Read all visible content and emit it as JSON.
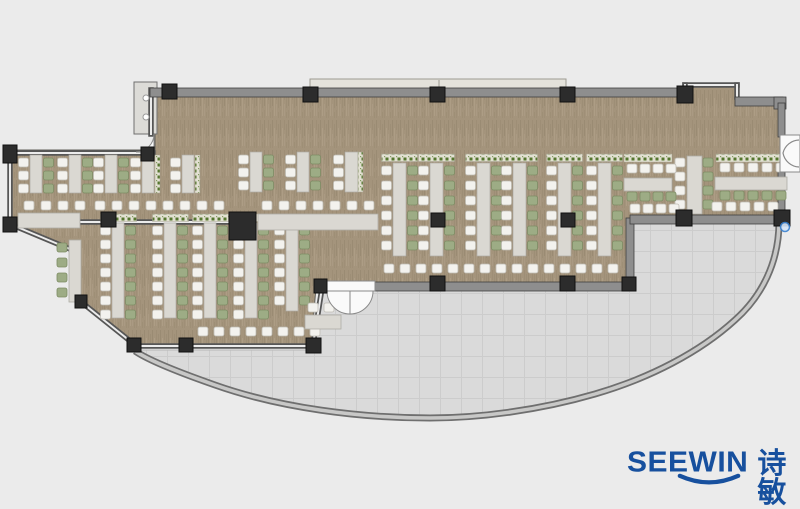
{
  "meta": {
    "width": 800,
    "height": 507,
    "description": "office floor plan with desk clusters, curved terrace and SEEWIN logo"
  },
  "brand": {
    "name": "SEEWIN",
    "cjk": "诗敏",
    "color": "#17509e"
  },
  "palette": {
    "background": "#ebebeb",
    "carpet_base": "#a4947c",
    "carpet_dark": "#8d7d66",
    "carpet_mid": "#97876f",
    "carpet_light": "#b5a68e",
    "carpet_edge": "#615f5a",
    "terrace": "#dadada",
    "terrace_line": "#cccccc",
    "terrace_edge": "#b7b7b7",
    "arc_dark": "#6f6f6f",
    "arc_light": "#c8c8c7",
    "wall_band": "#8e8e8e",
    "wall_edge": "#3f3f3f",
    "glass_dark": "#565656",
    "glass_light": "#ececec",
    "column": "#2c2c2c",
    "column_edge": "#101010",
    "desk": "#dad8d2",
    "desk_edge": "#aeaca5",
    "chair_white": "#f3f2ee",
    "chair_white_edge": "#bfbcb4",
    "chair_green": "#9dac85",
    "chair_green_edge": "#7d8c64",
    "planter_base": "#e2e0d2",
    "planter_dot": "#55762f",
    "planter_edge": "#a9a694",
    "door_fill": "#fafafa",
    "door_edge": "#8a8a8a",
    "handle_fill": "#d6e6f8",
    "handle_edge": "#3b82d0",
    "ledge_fill": "#e4e2db",
    "ledge_edge": "#9d9b92",
    "core_fill": "#dcdbd7",
    "core_edge": "#6f6f6f"
  },
  "floor": {
    "carpet_path": "M155,96 L685,96 L685,85 L737,85 L737,103 L781,103 L781,220 L630,220 L630,287 L316,287 L311,348 L134,346 L81,302 L76,252 L10,226 L10,150 L155,150 Z",
    "terrace_path": "M137,350 L311,350 L320,289 L628,289 L628,222 L779,222 C779,262 762,296 735,320 C700,352 650,378 595,394 C540,410 480,418 430,418 C360,418 280,408 215,385 C175,371 148,360 137,350 Z",
    "arc_path": "M779,222 C779,262 762,296 735,320 C700,352 650,378 595,394 C540,410 480,418 430,418 C360,418 280,408 215,385 C175,371 148,360 135,351"
  },
  "walls": {
    "bands": [
      {
        "x": 150,
        "y": 88,
        "w": 540,
        "h": 9
      },
      {
        "x": 735,
        "y": 97,
        "w": 48,
        "h": 9
      },
      {
        "x": 774,
        "y": 97,
        "w": 12,
        "h": 12
      },
      {
        "x": 373,
        "y": 282,
        "w": 259,
        "h": 9
      },
      {
        "x": 626,
        "y": 218,
        "w": 8,
        "h": 70
      },
      {
        "x": 630,
        "y": 215,
        "w": 156,
        "h": 9
      },
      {
        "x": 778,
        "y": 103,
        "w": 7,
        "h": 34
      },
      {
        "x": 778,
        "y": 170,
        "w": 7,
        "h": 50
      }
    ],
    "glass": [
      [
        8,
        153,
        153,
        153
      ],
      [
        10,
        150,
        10,
        226
      ],
      [
        10,
        224,
        77,
        252
      ],
      [
        78,
        252,
        78,
        300
      ],
      [
        80,
        301,
        135,
        345
      ],
      [
        135,
        346,
        315,
        346
      ],
      [
        313,
        345,
        322,
        288
      ],
      [
        151,
        90,
        151,
        134
      ],
      [
        80,
        222,
        228,
        222
      ],
      [
        685,
        85,
        737,
        85
      ],
      [
        685,
        85,
        685,
        96
      ],
      [
        737,
        85,
        737,
        97
      ]
    ],
    "ext_bands": [
      {
        "x": 310,
        "y": 79,
        "w": 256,
        "h": 12,
        "kind": "ledge"
      },
      {
        "x": 134,
        "y": 82,
        "w": 23,
        "h": 52,
        "kind": "core"
      }
    ],
    "ledge_divider": [
      439,
      80,
      439,
      90
    ]
  },
  "columns": [
    [
      3,
      145,
      14,
      18
    ],
    [
      141,
      147,
      13,
      14
    ],
    [
      3,
      217,
      14,
      15
    ],
    [
      162,
      84,
      15,
      15
    ],
    [
      303,
      87,
      15,
      15
    ],
    [
      430,
      87,
      15,
      15
    ],
    [
      560,
      87,
      15,
      15
    ],
    [
      677,
      86,
      16,
      17
    ],
    [
      101,
      212,
      15,
      15
    ],
    [
      229,
      212,
      27,
      28
    ],
    [
      431,
      213,
      14,
      14
    ],
    [
      561,
      213,
      14,
      14
    ],
    [
      430,
      276,
      15,
      15
    ],
    [
      560,
      276,
      15,
      15
    ],
    [
      622,
      277,
      14,
      14
    ],
    [
      314,
      279,
      13,
      14
    ],
    [
      306,
      338,
      15,
      15
    ],
    [
      179,
      338,
      14,
      14
    ],
    [
      127,
      338,
      14,
      14
    ],
    [
      75,
      295,
      12,
      13
    ],
    [
      676,
      210,
      16,
      16
    ],
    [
      774,
      210,
      16,
      16
    ]
  ],
  "furniture": {
    "v_clusters": [
      {
        "x": 393,
        "y": 163,
        "w": 13,
        "h": 93,
        "n": 6,
        "pitch": 15,
        "left": "white",
        "right": "green",
        "planter": true
      },
      {
        "x": 430,
        "y": 163,
        "w": 13,
        "h": 93,
        "n": 6,
        "pitch": 15,
        "left": "white",
        "right": "green",
        "planter": true
      },
      {
        "x": 477,
        "y": 163,
        "w": 13,
        "h": 93,
        "n": 6,
        "pitch": 15,
        "left": "white",
        "right": "green",
        "planter": true
      },
      {
        "x": 513,
        "y": 163,
        "w": 13,
        "h": 93,
        "n": 6,
        "pitch": 15,
        "left": "white",
        "right": "green",
        "planter": true
      },
      {
        "x": 558,
        "y": 163,
        "w": 13,
        "h": 93,
        "n": 6,
        "pitch": 15,
        "left": "white",
        "right": "green",
        "planter": true
      },
      {
        "x": 598,
        "y": 163,
        "w": 13,
        "h": 93,
        "n": 6,
        "pitch": 15,
        "left": "white",
        "right": "green",
        "planter": true
      },
      {
        "x": 250,
        "y": 152,
        "w": 12,
        "h": 40,
        "n": 3,
        "pitch": 13,
        "left": "white",
        "right": "green",
        "planter": false
      },
      {
        "x": 297,
        "y": 152,
        "w": 12,
        "h": 40,
        "n": 3,
        "pitch": 13,
        "left": "white",
        "right": "green",
        "planter": false
      },
      {
        "x": 345,
        "y": 152,
        "w": 13,
        "h": 40,
        "n": 3,
        "pitch": 13,
        "left": "white",
        "right": "none",
        "planter": false
      },
      {
        "x": 30,
        "y": 155,
        "w": 12,
        "h": 38,
        "n": 3,
        "pitch": 13,
        "left": "white",
        "right": "green",
        "planter": false
      },
      {
        "x": 69,
        "y": 155,
        "w": 12,
        "h": 38,
        "n": 3,
        "pitch": 13,
        "left": "white",
        "right": "green",
        "planter": false
      },
      {
        "x": 105,
        "y": 155,
        "w": 12,
        "h": 38,
        "n": 3,
        "pitch": 13,
        "left": "white",
        "right": "green",
        "planter": false
      },
      {
        "x": 142,
        "y": 155,
        "w": 12,
        "h": 38,
        "n": 3,
        "pitch": 13,
        "left": "white",
        "right": "none",
        "planter": false
      },
      {
        "x": 182,
        "y": 155,
        "w": 12,
        "h": 38,
        "n": 3,
        "pitch": 13,
        "left": "white",
        "right": "none",
        "planter": false
      },
      {
        "x": 112,
        "y": 223,
        "w": 12,
        "h": 95,
        "n": 7,
        "pitch": 14,
        "left": "white",
        "right": "green",
        "planter": true
      },
      {
        "x": 164,
        "y": 223,
        "w": 12,
        "h": 95,
        "n": 7,
        "pitch": 14,
        "left": "white",
        "right": "green",
        "planter": true
      },
      {
        "x": 204,
        "y": 223,
        "w": 12,
        "h": 95,
        "n": 7,
        "pitch": 14,
        "left": "white",
        "right": "green",
        "planter": true
      },
      {
        "x": 245,
        "y": 223,
        "w": 12,
        "h": 95,
        "n": 7,
        "pitch": 14,
        "left": "white",
        "right": "green",
        "planter": true
      },
      {
        "x": 286,
        "y": 223,
        "w": 12,
        "h": 88,
        "n": 6,
        "pitch": 14,
        "left": "white",
        "right": "green",
        "planter": true
      }
    ],
    "chair_cols": [
      {
        "x": 675,
        "y": 158,
        "n": 4,
        "pitch": 14,
        "color": "white"
      },
      {
        "x": 703,
        "y": 158,
        "n": 4,
        "pitch": 14,
        "color": "green"
      },
      {
        "x": 57,
        "y": 243,
        "n": 4,
        "pitch": 15,
        "color": "green"
      }
    ],
    "chair_rows": [
      {
        "x": 24,
        "y": 201,
        "n": 4,
        "pitch": 17,
        "color": "white"
      },
      {
        "x": 95,
        "y": 201,
        "n": 8,
        "pitch": 17,
        "color": "white"
      },
      {
        "x": 262,
        "y": 201,
        "n": 7,
        "pitch": 17,
        "color": "white"
      },
      {
        "x": 198,
        "y": 327,
        "n": 8,
        "pitch": 16,
        "color": "white"
      },
      {
        "x": 308,
        "y": 303,
        "n": 2,
        "pitch": 16,
        "color": "white"
      },
      {
        "x": 384,
        "y": 264,
        "n": 15,
        "pitch": 16,
        "color": "white"
      },
      {
        "x": 627,
        "y": 164,
        "n": 4,
        "pitch": 13,
        "color": "white"
      },
      {
        "x": 627,
        "y": 192,
        "n": 4,
        "pitch": 13,
        "color": "green"
      },
      {
        "x": 630,
        "y": 204,
        "n": 4,
        "pitch": 13,
        "color": "white"
      },
      {
        "x": 720,
        "y": 163,
        "n": 5,
        "pitch": 14,
        "color": "white"
      },
      {
        "x": 720,
        "y": 191,
        "n": 5,
        "pitch": 14,
        "color": "green"
      },
      {
        "x": 712,
        "y": 202,
        "n": 5,
        "pitch": 14,
        "color": "white"
      }
    ],
    "counters": [
      [
        18,
        213,
        62,
        15
      ],
      [
        258,
        214,
        120,
        16
      ],
      [
        624,
        178,
        48,
        13
      ],
      [
        715,
        177,
        72,
        13
      ],
      [
        687,
        156,
        15,
        58
      ],
      [
        69,
        240,
        12,
        62
      ],
      [
        305,
        315,
        36,
        14
      ]
    ],
    "planter_strips": [
      [
        624,
        154,
        48,
        8
      ],
      [
        716,
        154,
        70,
        8
      ],
      [
        358,
        152,
        5,
        40
      ],
      [
        155,
        155,
        5,
        38
      ],
      [
        195,
        155,
        5,
        38
      ]
    ]
  },
  "doors": {
    "panels": [
      {
        "path": "M325,281 L375,281 L375,291 L325,291 Z"
      },
      {
        "path": "M327,291 A23,23 0 0 0 350,314 L350,291 Z"
      },
      {
        "path": "M373,291 A23,23 0 0 1 350,314 L350,291 Z"
      },
      {
        "path": "M780,135 L800,135 L800,172 L780,172 Z"
      },
      {
        "path": "M154,134 A18,18 0 0 1 136,152 L154,152 Z"
      }
    ],
    "arcs": [
      {
        "path": "M799,140 A17,17 0 0 0 783,153 A17,17 0 0 0 799,167"
      }
    ]
  },
  "fixtures": {
    "circles": [
      [
        146,
        98,
        3
      ],
      [
        146,
        117,
        3
      ]
    ],
    "handle": [
      785,
      227,
      4.5
    ]
  }
}
